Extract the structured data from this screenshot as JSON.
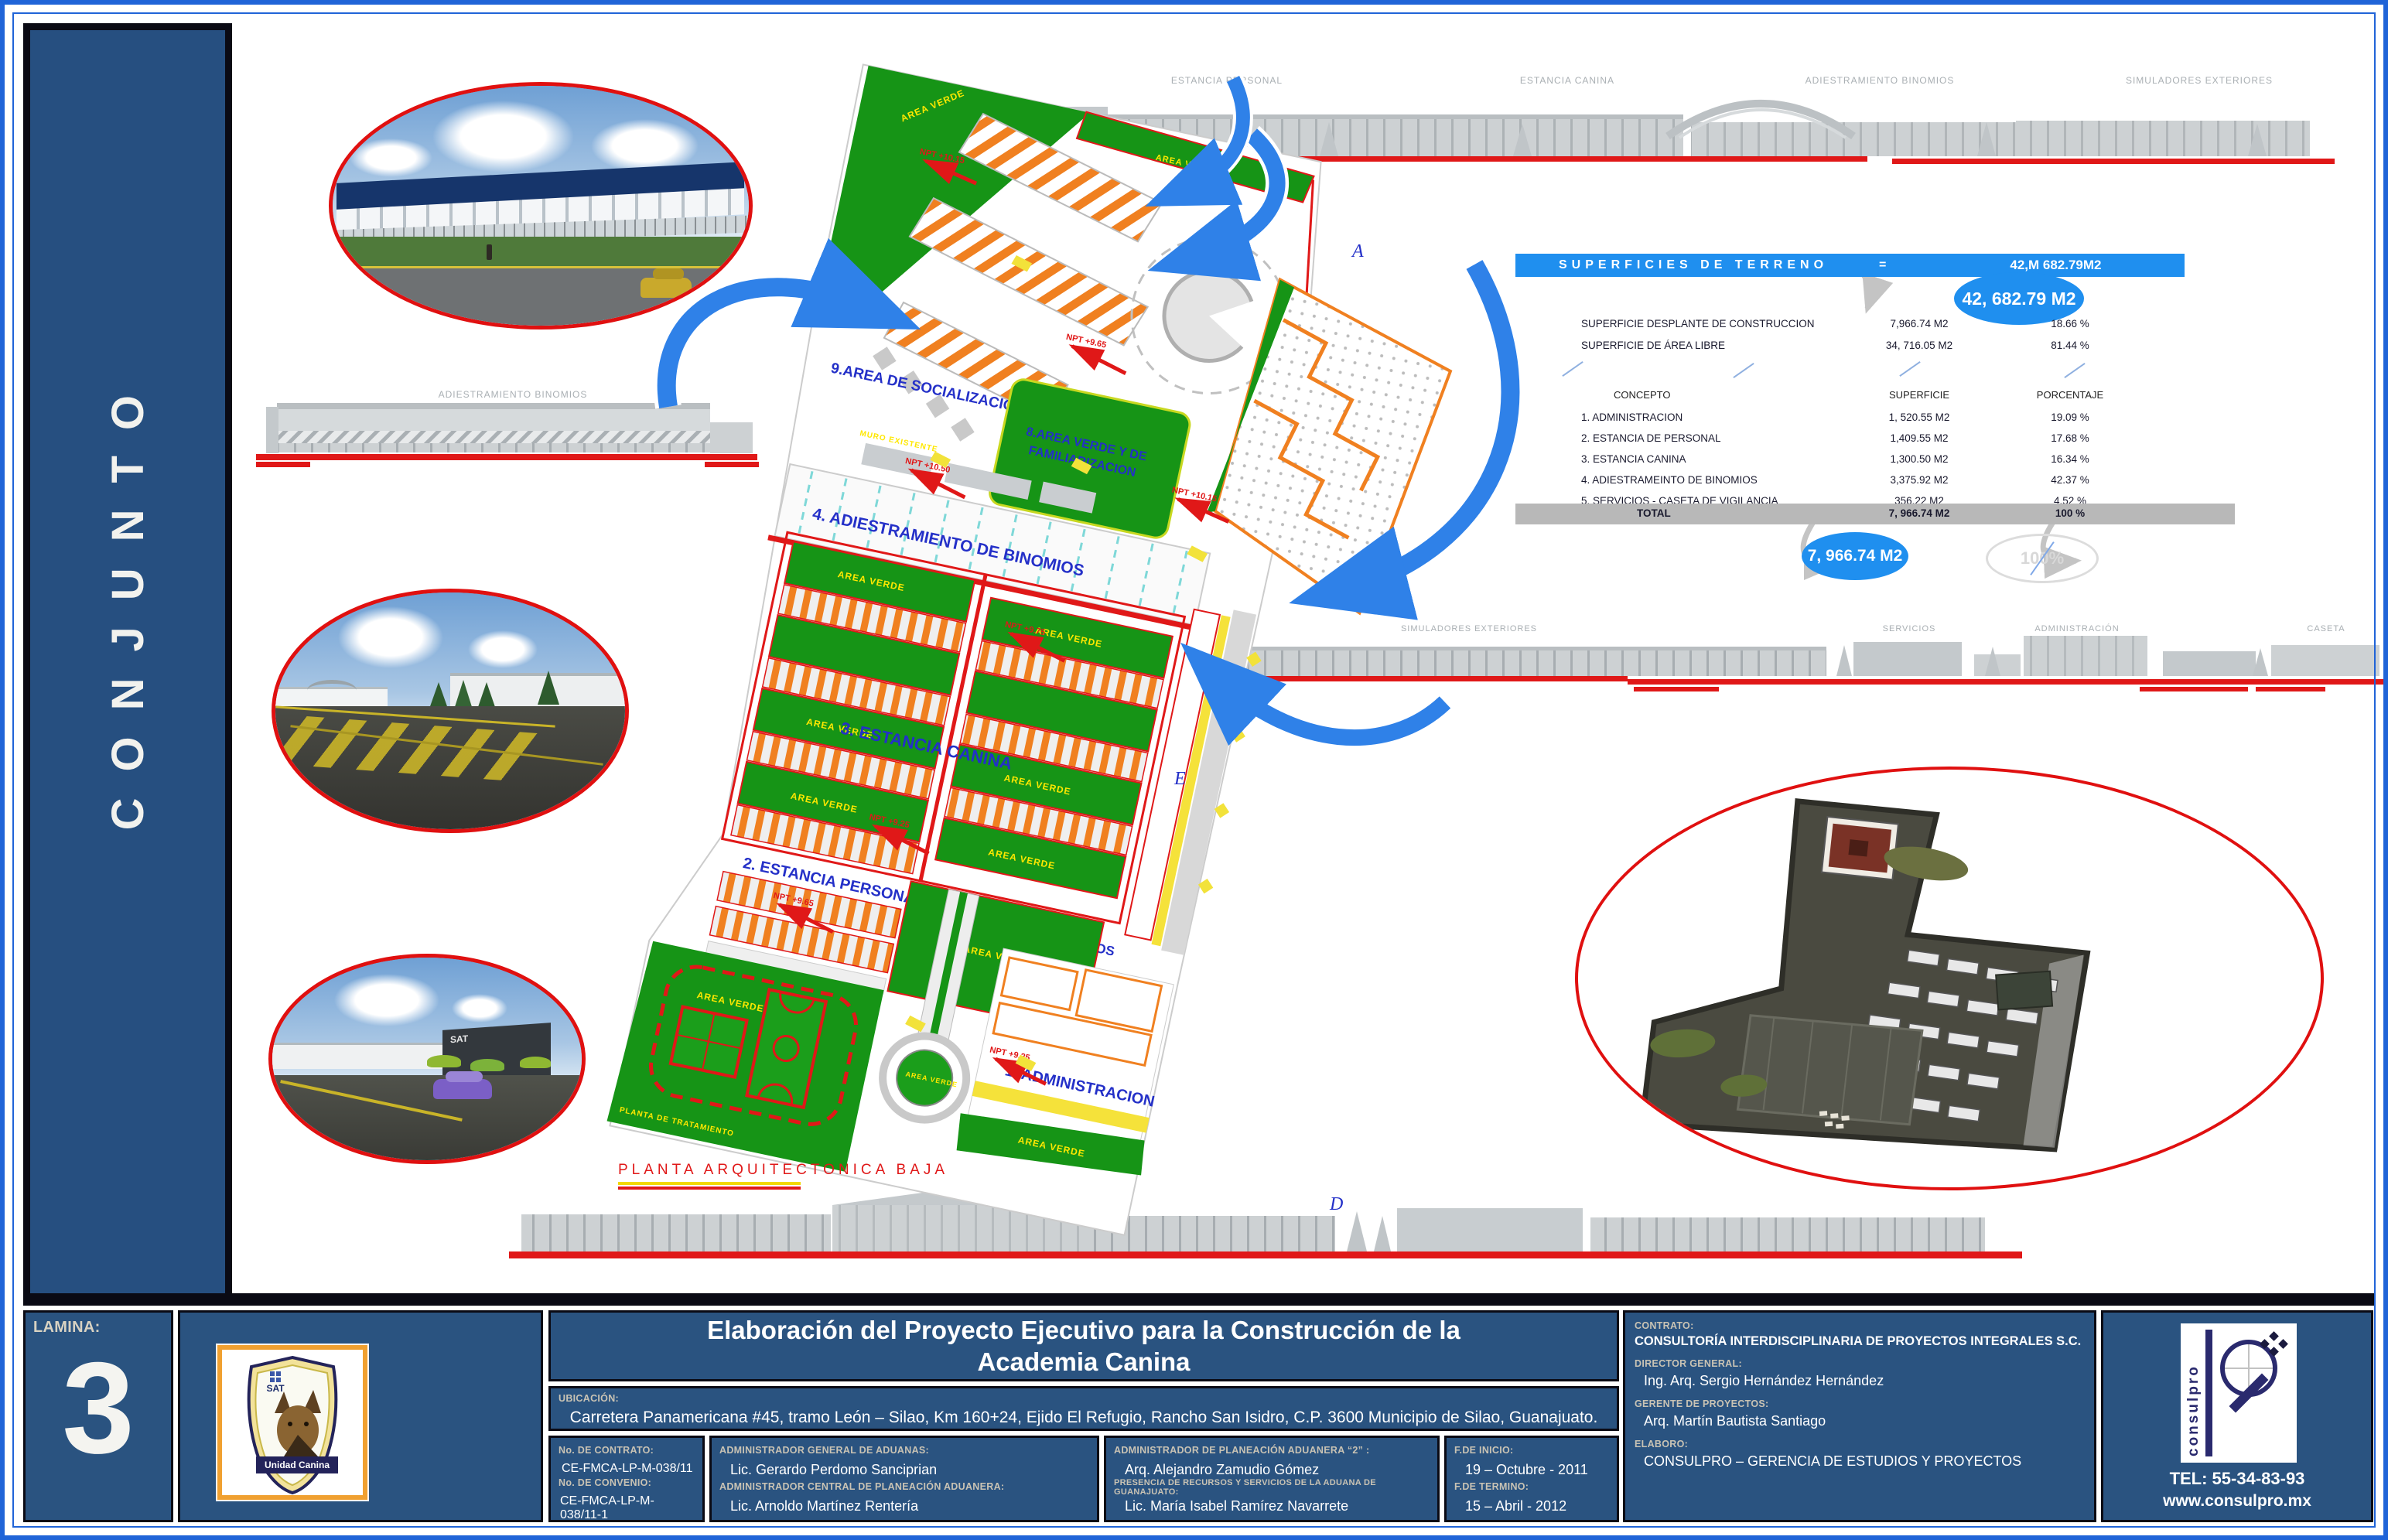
{
  "page": {
    "sidebar_title": "CONJUNTO",
    "lamina_label": "LAMINA:",
    "lamina_number": "3"
  },
  "badge": {
    "org": "SAT",
    "name": "Unidad Canina"
  },
  "title_block": {
    "title_line1": "Elaboración del Proyecto Ejecutivo para la Construcción de la",
    "title_line2": "Academia Canina",
    "ubicacion_label": "UBICACIÓN:",
    "ubicacion_value": "Carretera Panamericana #45, tramo León – Silao, Km 160+24, Ejido  El Refugio, Rancho  San Isidro,  C.P. 3600  Municipio de Silao, Guanajuato.",
    "no_contrato_label": "No. DE CONTRATO:",
    "no_contrato": "CE-FMCA-LP-M-038/11",
    "no_convenio_label": "No. DE CONVENIO:",
    "no_convenio": "CE-FMCA-LP-M-038/11-1",
    "admin_general_label": "ADMINISTRADOR GENERAL DE ADUANAS:",
    "admin_general": "Lic. Gerardo Perdomo Sanciprian",
    "admin_central_label": "ADMINISTRADOR CENTRAL DE PLANEACIÓN ADUANERA:",
    "admin_central": "Lic. Arnoldo Martínez Rentería",
    "admin_planeacion_label": "ADMINISTRADOR DE PLANEACIÓN ADUANERA “2” :",
    "admin_planeacion": "Arq. Alejandro Zamudio Gómez",
    "presencia_label": "PRESENCIA DE RECURSOS Y SERVICIOS DE LA ADUANA DE GUANAJUATO:",
    "presencia": "Lic. María Isabel Ramírez Navarrete",
    "f_inicio_label": "F.DE INICIO:",
    "f_inicio": "19 – Octubre - 2011",
    "f_termino_label": "F.DE TERMINO:",
    "f_termino": "15 – Abril - 2012",
    "contrato_label": "CONTRATO:",
    "contrato": "CONSULTORÍA INTERDISCIPLINARIA DE PROYECTOS INTEGRALES S.C.",
    "director_label": "DIRECTOR GENERAL:",
    "director": "Ing. Arq. Sergio Hernández  Hernández",
    "gerente_label": "GERENTE DE PROYECTOS:",
    "gerente": "Arq. Martín Bautista Santiago",
    "elaboro_label": "ELABORO:",
    "elaboro": "CONSULPRO – GERENCIA DE ESTUDIOS Y PROYECTOS"
  },
  "logo": {
    "brand": "consulpro",
    "tel": "TEL: 55-34-83-93",
    "web": "www.consulpro.mx"
  },
  "table": {
    "header": "SUPERFICIES DE TERRENO",
    "equals": "=",
    "header_value": "42,M 682.79M2",
    "total_bubble": "42, 682.79  M2",
    "desplante_label": "SUPERFICIE DESPLANTE DE CONSTRUCCION",
    "desplante_value": "7,966.74 M2",
    "desplante_pct": "18.66 %",
    "libre_label": "SUPERFICIE DE ÁREA LIBRE",
    "libre_value": "34, 716.05 M2",
    "libre_pct": "81.44 %",
    "col_concepto": "CONCEPTO",
    "col_superficie": "SUPERFICIE",
    "col_porcentaje": "PORCENTAJE",
    "rows": [
      {
        "concepto": "1. ADMINISTRACION",
        "superficie": "1, 520.55 M2",
        "porcentaje": "19.09 %"
      },
      {
        "concepto": "2. ESTANCIA DE PERSONAL",
        "superficie": "1,409.55 M2",
        "porcentaje": "17.68 %"
      },
      {
        "concepto": "3. ESTANCIA CANINA",
        "superficie": "1,300.50 M2",
        "porcentaje": "16.34 %"
      },
      {
        "concepto": "4. ADIESTRAMEINTO DE BINOMIOS",
        "superficie": "3,375.92 M2",
        "porcentaje": "42.37 %"
      },
      {
        "concepto": "5. SERVICIOS - CASETA DE VIGILANCIA",
        "superficie": "356.22 M2",
        "porcentaje": "4.52 %"
      }
    ],
    "total_label": "TOTAL",
    "total_value": "7, 966.74 M2",
    "total_pct": "100 %",
    "total_bubble2": "7, 966.74 M2",
    "total_pct_bubble": "100%"
  },
  "plan": {
    "labels": {
      "socializacion": "9.AREA DE SOCIALIZACION",
      "familiarizacion1": "8.AREA VERDE Y DE",
      "familiarizacion2": "FAMILIARIZACION",
      "binomios": "4. ADIESTRAMIENTO DE BINOMIOS",
      "estancia_canina": "3. ESTANCIA CANINA",
      "estancia_personal": "2. ESTANCIA PERSONAL",
      "administracion": "1. ADMINISTRACION",
      "servicios": "5. SERVICIOS",
      "area_verde": "AREA VERDE",
      "planta_baja": "PLANTA ARQUITECTONICA BAJA",
      "planta_tratamiento": "PLANTA DE TRATAMIENTO",
      "muro_existente": "MURO EXISTENTE"
    },
    "npt": [
      "NPT +10.50",
      "NPT +10.15",
      "NPT +9.65",
      "NPT +9.75",
      "NPT +9.25"
    ],
    "letters": {
      "a": "A",
      "c": "C",
      "d": "D",
      "e": "E"
    }
  },
  "elevations": {
    "top": [
      "ESTANCIA PERSONAL",
      "ESTANCIA CANINA",
      "ADIESTRAMIENTO BINOMIOS",
      "SIMULADORES EXTERIORES"
    ],
    "mid": [
      "SIMULADORES EXTERIORES",
      "SERVICIOS",
      "ADMINISTRACIÓN",
      "CASETA"
    ],
    "left_label": "ADIESTRAMIENTO BINOMIOS"
  },
  "colors": {
    "accent_blue": "#1f8fef",
    "navy_panel": "#2a5380",
    "plan_green": "#169416",
    "plan_orange": "#f08020",
    "plan_red": "#e01818",
    "ellipse_border_red": "#e01010"
  }
}
